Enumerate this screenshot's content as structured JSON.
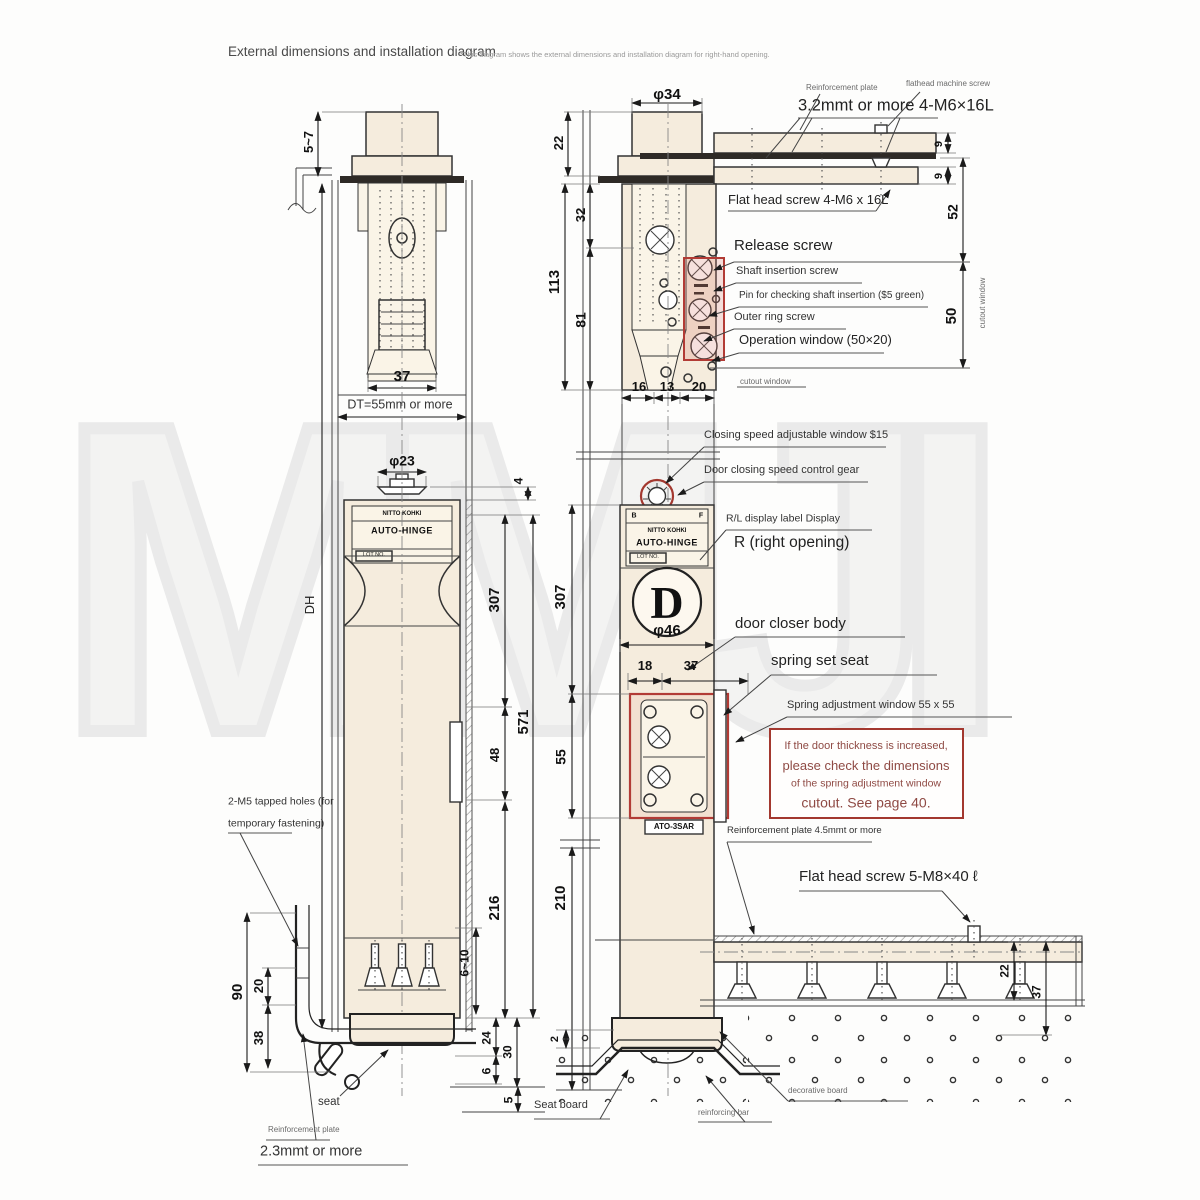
{
  "t": {
    "title": "External dimensions and installation diagram",
    "note": "*This diagram shows the external dimensions and installation diagram for right-hand opening."
  },
  "wm": "MMJI",
  "colors": {
    "accent_red": "#b23b35",
    "beige": "#f5ecdd",
    "note_red": "#8f4a44",
    "line": "#333333"
  },
  "L": {
    "d57": "5~7",
    "d37": "37",
    "dt": "DT=55mm or more",
    "p23": "φ23",
    "d4": "4",
    "dh": "DH",
    "d307": "307",
    "d571": "571",
    "d48": "48",
    "d216": "216",
    "d610": "6~10",
    "d90": "90",
    "d20": "20",
    "d38": "38",
    "d24": "24",
    "d30": "30",
    "d6": "6",
    "d5": "5",
    "tap1": "2-M5 tapped holes (for",
    "tap2": "temporary fastening)",
    "seat": "seat",
    "rp": "Reinforcement plate",
    "mmt": "2.3mmt or more"
  },
  "S": {
    "p34": "φ34",
    "d22": "22",
    "d32": "32",
    "d113": "113",
    "d81": "81",
    "d16": "16",
    "d13": "13",
    "d20": "20",
    "d9a": "9",
    "d9b": "9",
    "d52": "52",
    "d50": "50",
    "rp": "Reinforcement plate",
    "fms": "flathead machine screw",
    "mmt32": "3.2mmt or more 4-M6×16L",
    "fh46": "Flat head screw 4-M6 x 16L",
    "cw": "cutout window",
    "cw2": "cutout window",
    "rel": "Release screw",
    "shaft": "Shaft insertion screw",
    "pin": "Pin for checking shaft insertion ($5 green)",
    "oring": "Outer ring screw",
    "opw": "Operation window (50×20)",
    "csw": "Closing speed adjustable window $15",
    "gear": "Door closing speed control gear",
    "rl": "R/L display label Display",
    "ro": "R (right opening)",
    "d307": "307",
    "p46": "φ46",
    "d18": "18",
    "d37": "37",
    "d55": "55",
    "d210": "210",
    "dcb": "door closer body",
    "sss": "spring set seat",
    "saw": "Spring adjustment window 55 x 55",
    "n1": "If the door thickness is increased,",
    "n2": "please check the dimensions",
    "n3": "of the spring adjustment window",
    "n4": "cutout. See page 40.",
    "rp45": "Reinforcement plate 4.5mmt or more",
    "fh58": "Flat head screw 5-M8×40 ℓ",
    "d22b": "22",
    "d37b": "37",
    "d2": "2",
    "sb": "Seat board",
    "rb": "reinforcing bar",
    "db": "decorative board"
  },
  "logo": {
    "maker": "NITTO KOHKI",
    "brand": "AUTO-HINGE",
    "lot": "LOT NO.",
    "b": "B",
    "f": "F",
    "d": "D",
    "model": "ATO-3SAR"
  }
}
